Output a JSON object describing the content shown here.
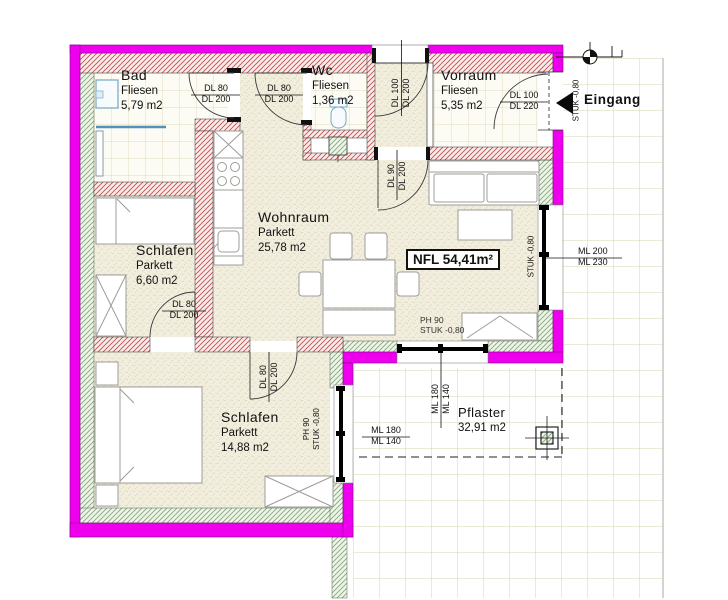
{
  "plan": {
    "rooms": {
      "bad": {
        "name": "Bad",
        "material": "Fliesen",
        "area": "5,79 m2"
      },
      "wc": {
        "name": "Wc",
        "material": "Fliesen",
        "area": "1,36 m2"
      },
      "vorraum": {
        "name": "Vorraum",
        "material": "Fliesen",
        "area": "5,35 m2"
      },
      "wohnraum": {
        "name": "Wohnraum",
        "material": "Parkett",
        "area": "25,78 m2"
      },
      "schlafen_klein": {
        "name": "Schlafen",
        "material": "Parkett",
        "area": "6,60 m2"
      },
      "schlafen_gross": {
        "name": "Schlafen",
        "material": "Parkett",
        "area": "14,88 m2"
      },
      "pflaster": {
        "name": "Pflaster",
        "area": "32,91 m2"
      }
    },
    "total_area_label": "NFL 54,41m²",
    "entrance_label": "Eingang",
    "dims": {
      "bad_door": {
        "l1": "DL 80",
        "l2": "DL 200"
      },
      "wc_door": {
        "l1": "DL 80",
        "l2": "DL 200"
      },
      "top_door": {
        "l1": "DL 100",
        "l2": "DL 200"
      },
      "vorraum_wohnraum_door": {
        "l1": "DL 90",
        "l2": "DL 200"
      },
      "entry_door": {
        "l1": "DL 100",
        "l2": "DL 220"
      },
      "schlafen_klein_door": {
        "l1": "DL 80",
        "l2": "DL 200"
      },
      "schlafen_gross_door": {
        "l1": "DL 80",
        "l2": "DL 200"
      },
      "window_right": {
        "l1": "ML 200",
        "l2": "ML 230"
      },
      "window_south": {
        "l1": "ML 180",
        "l2": "ML 140"
      },
      "window_west": {
        "l1": "ML 180",
        "l2": "ML 140"
      }
    },
    "notes": {
      "entry_sill": "STUK -0,80",
      "right_window_sill": "STUK -0,80",
      "south_window": {
        "l1": "PH 90",
        "l2": "STUK -0,80"
      },
      "west_window": {
        "l1": "PH 90",
        "l2": "STUK -0,80"
      }
    },
    "colors": {
      "outer_wall": "#EE00EE",
      "wall_hatch": "#C25050",
      "insulation": "#84A87E"
    }
  }
}
